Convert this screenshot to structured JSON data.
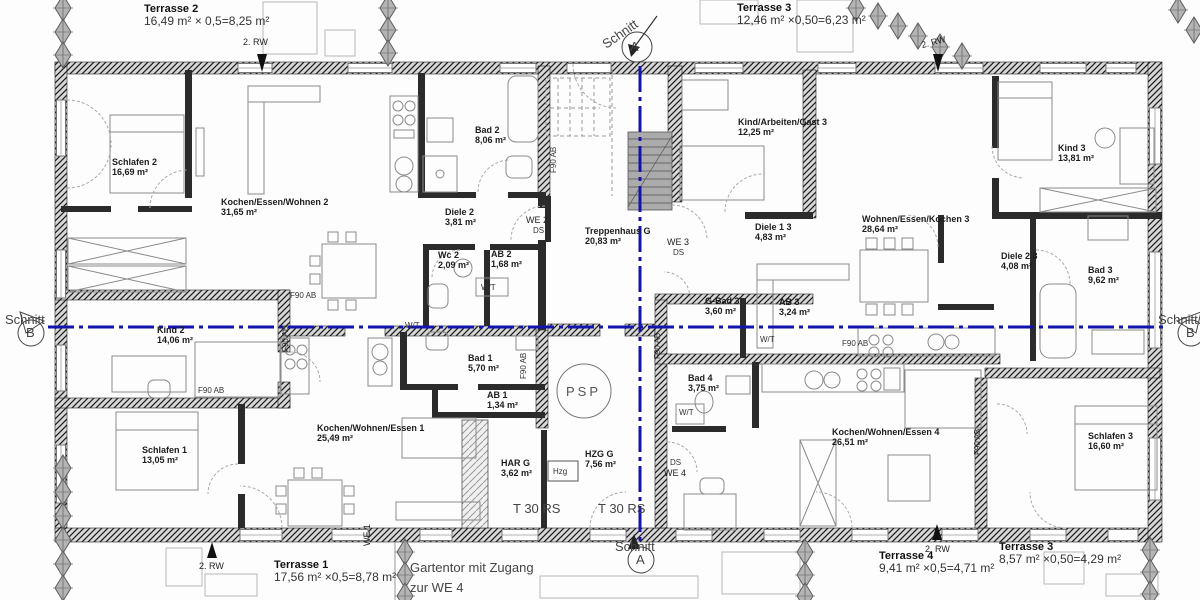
{
  "rooms": [
    {
      "name": "Schlafen 2",
      "area": "16,69 m²"
    },
    {
      "name": "Kochen/Essen/Wohnen 2",
      "area": "31,65 m²"
    },
    {
      "name": "Bad 2",
      "area": "8,06 m²"
    },
    {
      "name": "Diele 2",
      "area": "3,81 m²"
    },
    {
      "name": "Wc 2",
      "area": "2,09 m²"
    },
    {
      "name": "AB 2",
      "area": "1,68 m²"
    },
    {
      "name": "Kind 2",
      "area": "14,06 m²"
    },
    {
      "name": "Schlafen 1",
      "area": "13,05 m²"
    },
    {
      "name": "Kochen/Wohnen/Essen 1",
      "area": "25,49 m²"
    },
    {
      "name": "Bad 1",
      "area": "5,70 m²"
    },
    {
      "name": "AB 1",
      "area": "1,34 m²"
    },
    {
      "name": "Treppenhaus G",
      "area": "20,83 m²"
    },
    {
      "name": "HAR G",
      "area": "3,62 m²"
    },
    {
      "name": "HZG G",
      "area": "7,56 m²"
    },
    {
      "name": "Kind/Arbeiten/Gast 3",
      "area": "12,25 m²"
    },
    {
      "name": "Diele 1 3",
      "area": "4,83 m²"
    },
    {
      "name": "G-Bad 3",
      "area": "3,60 m²"
    },
    {
      "name": "AB 3",
      "area": "3,24 m²"
    },
    {
      "name": "Wohnen/Essen/Kochen 3",
      "area": "28,64 m²"
    },
    {
      "name": "Kind 3",
      "area": "13,81 m²"
    },
    {
      "name": "Diele 2 3",
      "area": "4,08 m²"
    },
    {
      "name": "Bad 3",
      "area": "9,62 m²"
    },
    {
      "name": "Bad 4",
      "area": "3,75 m²"
    },
    {
      "name": "Kochen/Wohnen/Essen 4",
      "area": "26,51 m²"
    },
    {
      "name": "Schlafen 3",
      "area": "16,60 m²"
    }
  ],
  "terraces": [
    {
      "name": "Terrasse 2",
      "calc": "16,49 m² × 0,5=8,25 m²"
    },
    {
      "name": "Terrasse 3",
      "calc": "12,46 m² ×0,50=6,23 m²"
    },
    {
      "name": "Terrasse 1",
      "calc": "17,56 m² ×0,5=8,78 m²"
    },
    {
      "name": "Terrasse 4",
      "calc": "9,41 m² ×0,5=4,71 m²"
    },
    {
      "name": "Terrasse 3",
      "calc": "8,57 m² ×0,50=4,29 m²"
    }
  ],
  "labels": {
    "rw": "2. RW",
    "we1": "WE 1",
    "we2": "WE 2",
    "we3": "WE 3",
    "we4": "WE 4",
    "ds": "DS",
    "wt": "W/T",
    "f90": "F90 AB",
    "psp": "PSP",
    "hzg": "Hzg",
    "t30": "T 30 RS",
    "schnitt": "Schnitt",
    "section_a": "A",
    "section_b": "B",
    "gate_line1": "Gartentor mit Zugang",
    "gate_line2": "zur WE 4"
  },
  "colors": {
    "section_line": "#1313ad",
    "wall": "#2b2b2b",
    "tree": "#b4b4b4"
  }
}
